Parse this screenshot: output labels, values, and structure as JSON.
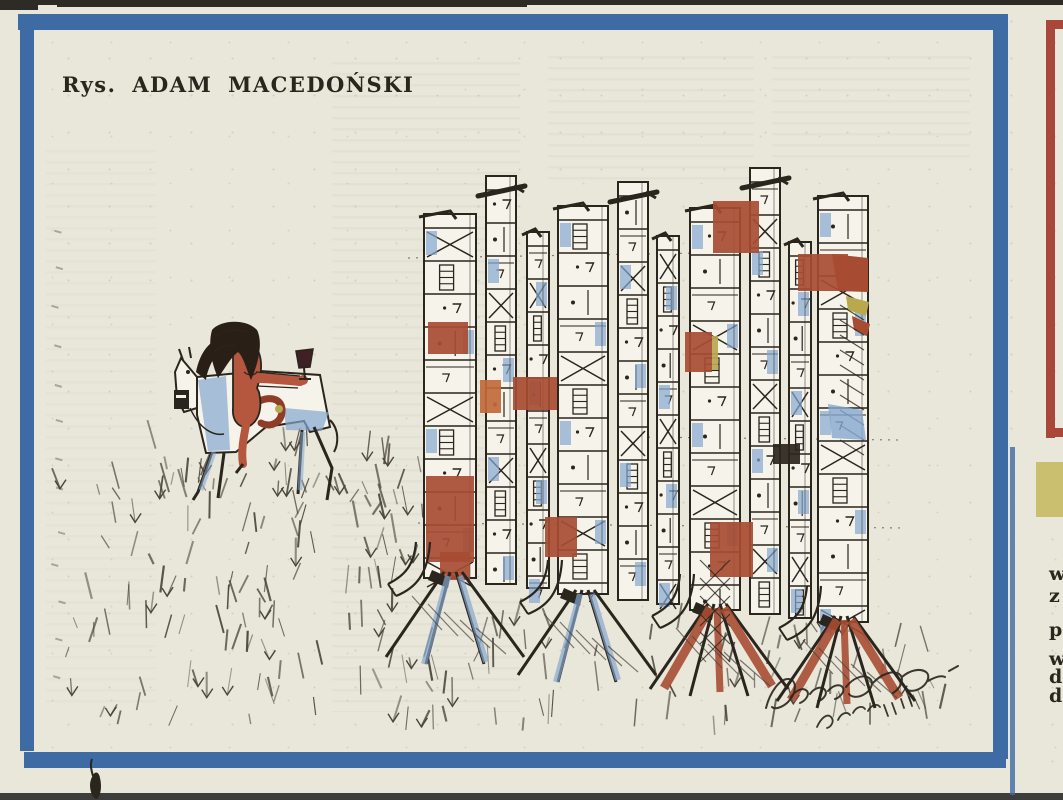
{
  "page": {
    "caption": "Rys. ADAM MACEDOŃSKI"
  },
  "margin_column": {
    "clipped_letters": [
      "w",
      "z",
      "p",
      "w",
      "d",
      "d"
    ]
  },
  "colors": {
    "paper": "#e9e6da",
    "paper_light": "#f5f3ea",
    "ink": "#2a251d",
    "frame_blue": "#3e6ba3",
    "wash_blue": "#84a7cf",
    "sienna": "#a74c32",
    "orange": "#c06a3a",
    "olive": "#b8a84e",
    "margin_red": "#a9473a",
    "margin_yellow": "#cabf6e",
    "skin": "#b5573f",
    "hair": "#2a1f17",
    "wine": "#3f2024",
    "scan_top": "#2e2b27",
    "scan_bottom": "#3d3d3b",
    "grass_ink": "#4a443a"
  }
}
